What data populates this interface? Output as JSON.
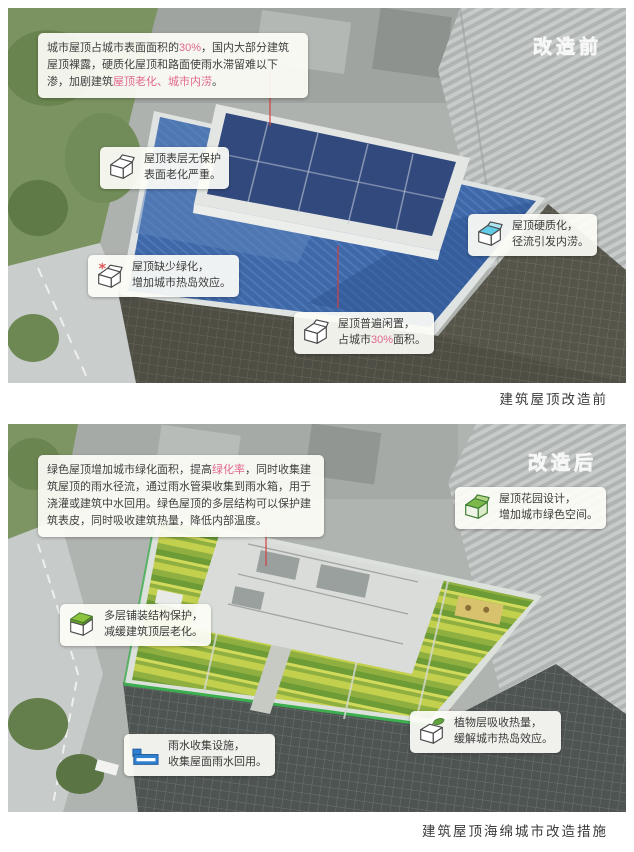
{
  "colors": {
    "highlight_pink": "#e2688c",
    "roof_blue": "#3f68a8",
    "roof_green": "#8fb040",
    "water_blue": "#2f80d0",
    "leader_red": "#d04040"
  },
  "before": {
    "watermark": "改造前",
    "caption": "建筑屋顶改造前",
    "intro": [
      {
        "t": "城市屋顶占城市表面面积的"
      },
      {
        "t": "30%",
        "hl": true
      },
      {
        "t": "，国内大部分建筑屋顶裸露，硬质化屋顶和路面使雨水滞留难以下渗，加剧建筑"
      },
      {
        "t": "屋顶老化、城市内涝",
        "hl": true
      },
      {
        "t": "。"
      }
    ],
    "annotations": [
      {
        "icon": "cube-open",
        "lines": [
          [
            {
              "t": "屋顶表层无保护"
            }
          ],
          [
            {
              "t": "表面老化严重。"
            }
          ]
        ]
      },
      {
        "icon": "cube-heat",
        "lines": [
          [
            {
              "t": "屋顶缺少绿化，"
            }
          ],
          [
            {
              "t": "增加城市热岛效应。"
            }
          ]
        ]
      },
      {
        "icon": "cube-water",
        "lines": [
          [
            {
              "t": "屋顶硬质化，"
            }
          ],
          [
            {
              "t": "径流引发内涝。"
            }
          ]
        ]
      },
      {
        "icon": "cube-open",
        "lines": [
          [
            {
              "t": "屋顶普遍闲置，"
            }
          ],
          [
            {
              "t": "占城市"
            },
            {
              "t": "30%",
              "hl": true
            },
            {
              "t": "面积。"
            }
          ]
        ]
      }
    ]
  },
  "after": {
    "watermark": "改造后",
    "caption": "建筑屋顶海绵城市改造措施",
    "intro": [
      {
        "t": "绿色屋顶增加城市绿化面积，提高"
      },
      {
        "t": "绿化率",
        "hl": true
      },
      {
        "t": "，同时收集建筑屋顶的雨水径流，通过雨水管渠收集到雨水箱，用于浇灌或建筑中水回用。绿色屋顶的多层结构可以保护建筑表皮，同时吸收建筑热量，降低内部温度。"
      }
    ],
    "annotations": [
      {
        "icon": "cube-garden",
        "lines": [
          [
            {
              "t": "屋顶花园设计，"
            }
          ],
          [
            {
              "t": "增加城市绿色空间。"
            }
          ]
        ]
      },
      {
        "icon": "cube-layer",
        "lines": [
          [
            {
              "t": "多层铺装结构保护，"
            }
          ],
          [
            {
              "t": "减缓建筑顶层老化。"
            }
          ]
        ]
      },
      {
        "icon": "cube-leaf",
        "lines": [
          [
            {
              "t": "植物层吸收热量，"
            }
          ],
          [
            {
              "t": "缓解城市热岛效应。"
            }
          ]
        ]
      },
      {
        "icon": "tank",
        "lines": [
          [
            {
              "t": "雨水收集设施，"
            }
          ],
          [
            {
              "t": "收集屋面雨水回用。"
            }
          ]
        ]
      }
    ]
  }
}
